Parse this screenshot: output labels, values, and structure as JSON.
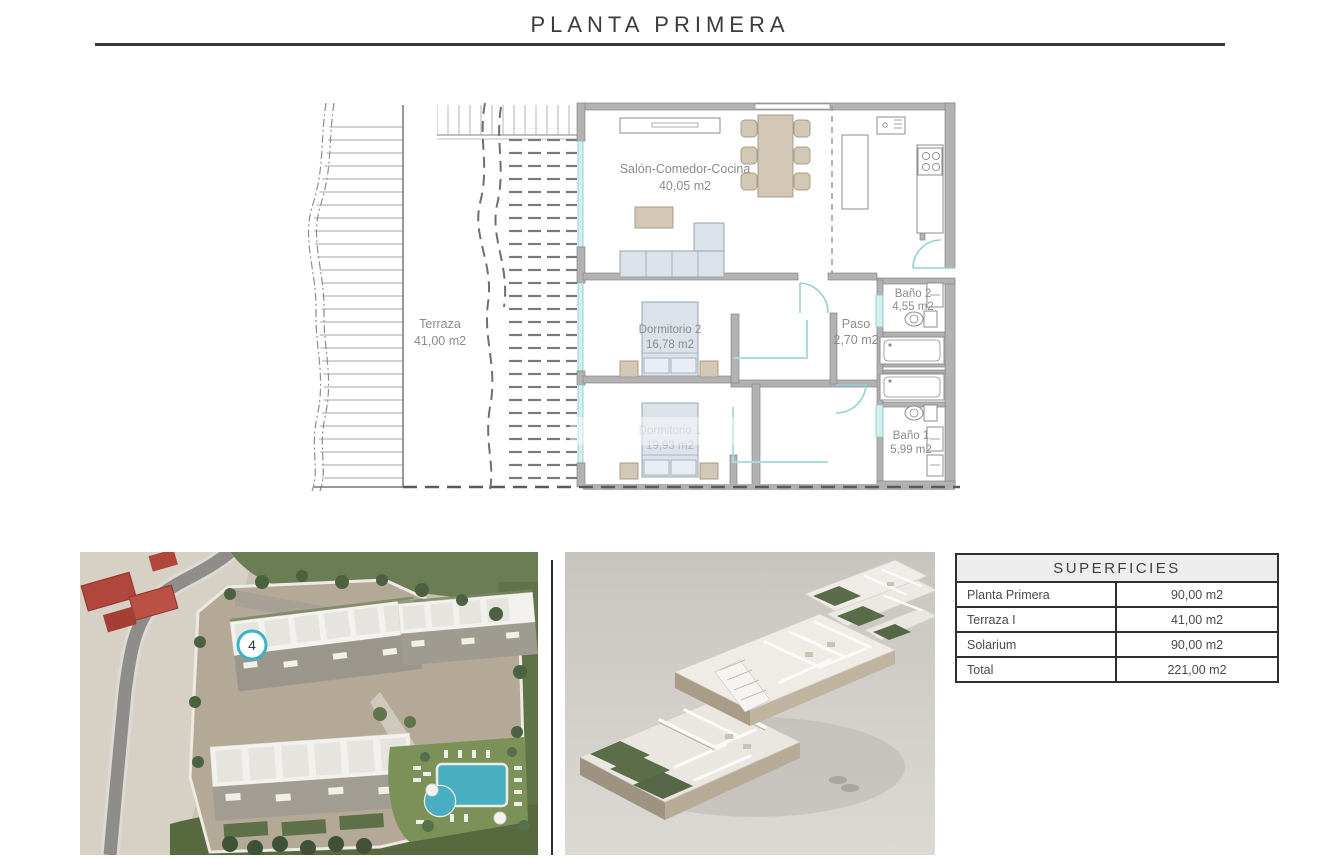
{
  "page_title": "PLANTA PRIMERA",
  "floor_plan": {
    "rooms": {
      "terraza": {
        "name": "Terraza",
        "area": "41,00 m2"
      },
      "salon": {
        "name": "Salón-Comedor-Cocina",
        "area": "40,05 m2"
      },
      "dormitorio2": {
        "name": "Dormitorio 2",
        "area": "16,78 m2"
      },
      "dormitorio1": {
        "name": "Dormitorio 1",
        "area": "19,93 m2"
      },
      "paso": {
        "name": "Paso",
        "area": "2,70 m2"
      },
      "bano2": {
        "name": "Baño 2",
        "area": "4,55 m2"
      },
      "bano1": {
        "name": "Baño 1",
        "area": "5,99 m2"
      }
    }
  },
  "site_photo": {
    "unit_badge": "4"
  },
  "superficies_table": {
    "title": "SUPERFICIES",
    "rows": [
      {
        "label": "Planta Primera",
        "value": "90,00 m2"
      },
      {
        "label": "Terraza I",
        "value": "41,00 m2"
      },
      {
        "label": "Solarium",
        "value": "90,00 m2"
      },
      {
        "label": "Total",
        "value": "221,00 m2"
      }
    ]
  },
  "colors": {
    "accent_teal": "#7fcdd3",
    "wall_gray": "#b2b2b2",
    "pool_blue": "#49aec2",
    "badge_ring": "#3ab3c6"
  }
}
